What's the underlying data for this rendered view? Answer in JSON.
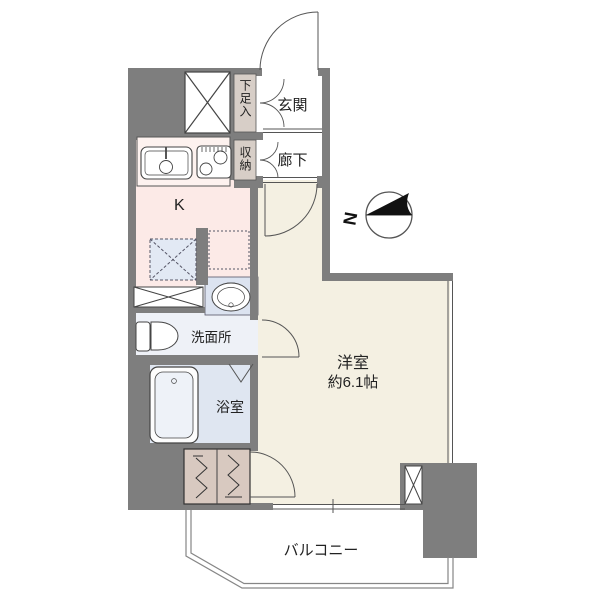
{
  "floorplan": {
    "rooms": {
      "entrance": {
        "label": "玄関"
      },
      "hallway": {
        "label": "廊下"
      },
      "shoe_box": {
        "label": "下足入"
      },
      "storage": {
        "label": "収納"
      },
      "kitchen": {
        "label": "K"
      },
      "washroom": {
        "label": "洗面所"
      },
      "bathroom": {
        "label": "浴室"
      },
      "western_room": {
        "label": "洋室",
        "size": "約6.1帖"
      },
      "balcony": {
        "label": "バルコニー"
      }
    },
    "compass": {
      "north_label": "N"
    }
  },
  "colors": {
    "wall": "#7e7e7e",
    "room_floor": "#f4f0e2",
    "kitchen_floor": "#fceae7",
    "kitchen_counter": "#fdf2ef",
    "washroom_floor": "#eef1f7",
    "basin_counter": "#dce3f0",
    "bathroom_floor": "#dfe6f1",
    "storage_fill": "#d7cec7",
    "closet_fill": "#d8c9c0",
    "fridge_space_fill": "#e2e9f4",
    "washer_space_fill": "#fceae7",
    "line": "#555555",
    "compass_fill": "#111111"
  }
}
